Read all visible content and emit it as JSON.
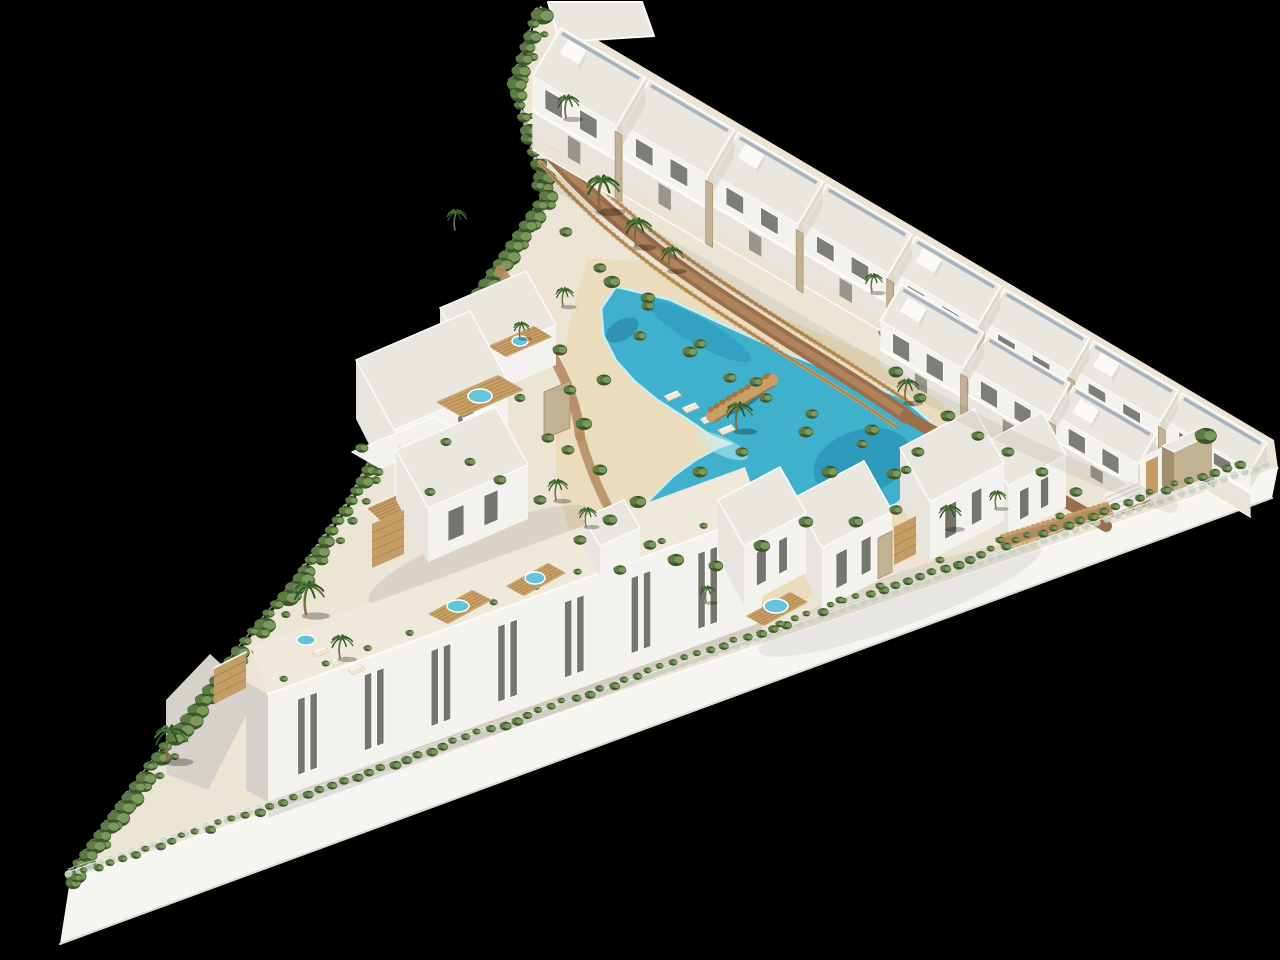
{
  "scene": {
    "type": "aerial-3d-architectural-render",
    "subject": "White Mediterranean-style residential resort complex on a triangular hillside plot",
    "background": "solid black backdrop",
    "description": "Bird's-eye CGI marketing render. A free-form turquoise lagoon pool with sandy beach edges and a timber footbridge occupies the centre, surrounded by palm trees, shrubs and timber fences. A stepped row of two-storey townhouses with speckled flat roofs, balconies and stone-clad piers runs along the upper boundary; a shorter second row steps down the eastern side toward a gated entrance with a stone portal and a timber-railed ramp. Detached villas with timber roof decks, spa tubs, pergolas and lounger terraces occupy the west-centre. A three-storey apartment block with slim paired windows and rooftop spa decks lines the lower edge. A bright retaining wall topped with a wire fence and continuous hedge bounds the whole site, with a gravel patio and tall palm at the south-west tip.",
    "inventory": {
      "townhouse_units_upper_row": 8,
      "townhouse_units_lower_row": 3,
      "detached_villas": 7,
      "apartment_window_bays": 7,
      "rooftop_spa_tubs": 6,
      "lagoon_pools": 1,
      "footbridges": 1,
      "palm_trees": 18,
      "sun_loungers": 9
    }
  },
  "colors": {
    "background": "#000000",
    "siteBase": "#ece5d5",
    "wallFace": "#f6f5f2",
    "wallShade": "#dad7d0",
    "facadeBright": "#f4f2ee",
    "facadeMid": "#e8e4de",
    "facadeShade": "#d4d0ca",
    "facadeDark": "#bab5af",
    "roof": "#eae6e0",
    "parapet": "#fbfaf7",
    "skylight": "#8fa0b0",
    "window": "#75746f",
    "windowFrame": "#fdfdfc",
    "door": "#8a8680",
    "stone": "#c2b193",
    "stoneDark": "#a2906d",
    "wood": "#c49c66",
    "woodDark": "#a0763f",
    "deck": "#c8a066",
    "spa": "#64c4d9",
    "water": "#3fb1cd",
    "waterDeep": "#1d86ac",
    "waterRim": "#c9edf3",
    "sand": "#eadcbc",
    "sandShade": "#dcc9a3",
    "dirt": "#9b6e4c",
    "dirtLight": "#b48a5f",
    "hedge": "#5d7c45",
    "hedgeDark": "#3f562d",
    "hedgeLight": "#7fa05f",
    "palm": "#4e793b",
    "palmDark": "#2f5021",
    "trunk": "#8a6a48",
    "pave": "#d6d2cb",
    "fence": "#e7ebe3",
    "fencePost": "#c9cfc4",
    "shadow": "#000000"
  }
}
